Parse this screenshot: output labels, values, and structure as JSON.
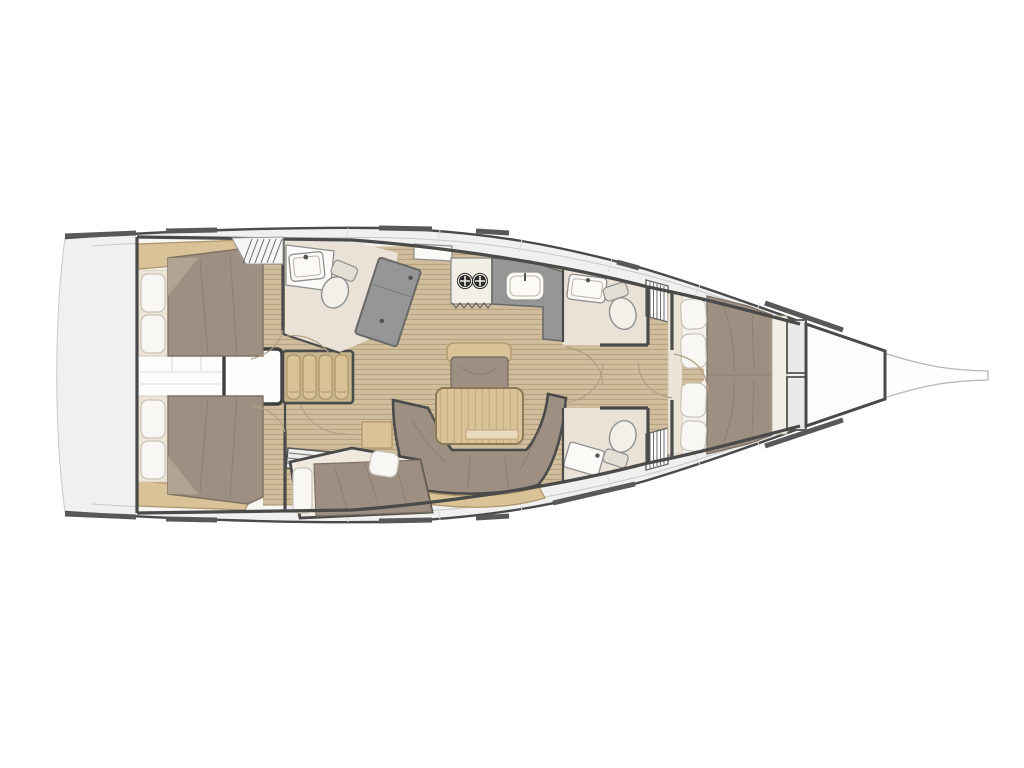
{
  "figure": {
    "kind": "sailing yacht interior floor plan",
    "view": "top-down deck plan",
    "orientation": "bow to the right, stern to the left",
    "layout_summary": "4 cabins, aft head with shower, galley amidships port, saloon with U-settee and table, two forward heads, owner forward cabin, forepeak locker, bowsprit"
  },
  "palette": {
    "hull_line": "#4a4a4a",
    "deck": "#f0f0ee",
    "teak_floor": "#cfbd9c",
    "teak_stripe": "#b7a381",
    "upholstery": "#9d9082",
    "upholstery_stroke": "#7d7164",
    "counter_gray": "#969696",
    "counter_stroke": "#6a6a6a",
    "bath_floor": "#eae2d7",
    "wood": "#d9c298",
    "pillow": "#f8f7f3",
    "cream": "#ece4d6",
    "white_fixture": "#fbfaf6"
  },
  "rooms": {
    "hull": {
      "label": "Hull outline with toe-rail segments"
    },
    "bowsprit": {
      "label": "Bowsprit"
    },
    "forepeak": {
      "label": "Forepeak sail locker"
    },
    "forward_cabin": {
      "label": "Forward owner cabin with island double berth and four pillows"
    },
    "forward_head_port": {
      "label": "Forward head (port) with washbasin and marine toilet"
    },
    "forward_head_starboard": {
      "label": "Forward head (starboard) with vanity desk and marine toilet"
    },
    "wardrobe_port": {
      "label": "Hanging locker (louvered)"
    },
    "wardrobe_starboard": {
      "label": "Hanging locker (louvered)"
    },
    "saloon": {
      "label": "Saloon with U-shaped settee, folding table and bench seat"
    },
    "galley": {
      "label": "Galley with two-burner stove, sink and angled counter module"
    },
    "aft_head": {
      "label": "Aft head with washbasin, toilet and shower module"
    },
    "companionway": {
      "label": "Companionway steps from cockpit"
    },
    "engine_box": {
      "label": "Engine compartment under companionway"
    },
    "corridor": {
      "label": "Aft corridor between cabins"
    },
    "aft_cabin_port": {
      "label": "Aft cabin (port) with double berth"
    },
    "aft_cabin_starboard": {
      "label": "Aft cabin (starboard) with double berth"
    },
    "mid_cabin": {
      "label": "Mid cabin with angled berth and access steps"
    },
    "hatch": {
      "label": "Companionway hatch (hatched)"
    }
  }
}
